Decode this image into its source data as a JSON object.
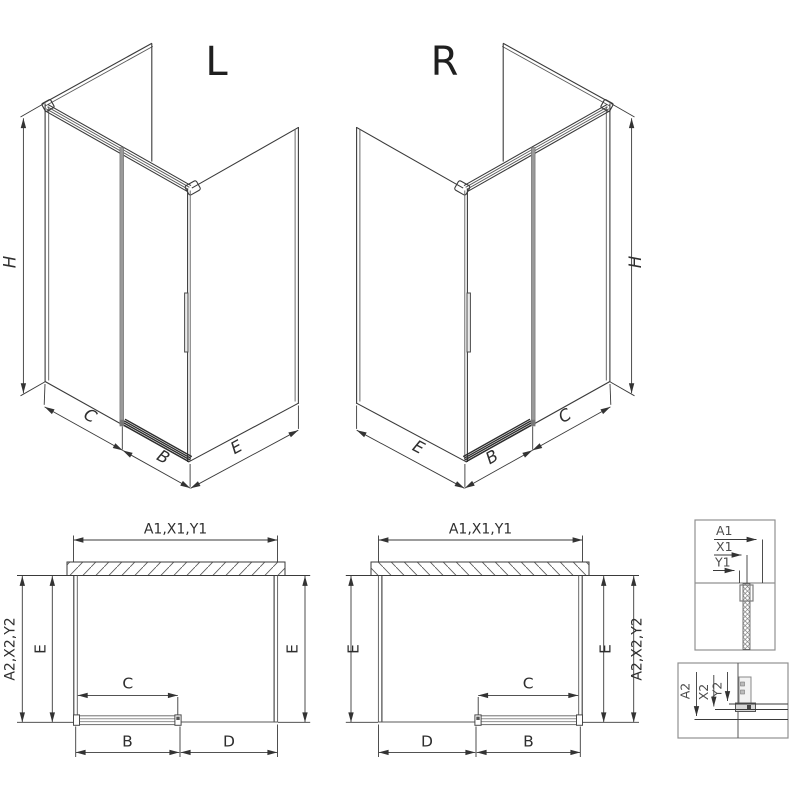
{
  "iso_left": {
    "label": "L",
    "dim_height": "H",
    "dim_side": "C",
    "dim_door": "B",
    "dim_depth": "E"
  },
  "iso_right": {
    "label": "R",
    "dim_height": "H",
    "dim_depth": "E",
    "dim_door": "B",
    "dim_side": "C"
  },
  "plan_left": {
    "dim_top": "A1,X1,Y1",
    "dim_outer_left": "A2,X2,Y2",
    "dim_inner_left": "E",
    "dim_right": "E",
    "dim_door_panel": "C",
    "dim_bottom_left": "B",
    "dim_bottom_right": "D"
  },
  "plan_right": {
    "dim_top": "A1,X1,Y1",
    "dim_left": "E",
    "dim_inner_right": "E",
    "dim_outer_right": "A2,X2,Y2",
    "dim_door_panel": "C",
    "dim_bottom_left": "D",
    "dim_bottom_right": "B"
  },
  "detail_top": {
    "labels": [
      "A1",
      "X1",
      "Y1"
    ]
  },
  "detail_bottom": {
    "labels": [
      "A2",
      "X2",
      "Y2"
    ]
  },
  "colors": {
    "line": "#3a3a3a",
    "light_line": "#8f8f8f",
    "profile_gray": "#9a9a9a",
    "background": "#ffffff"
  }
}
